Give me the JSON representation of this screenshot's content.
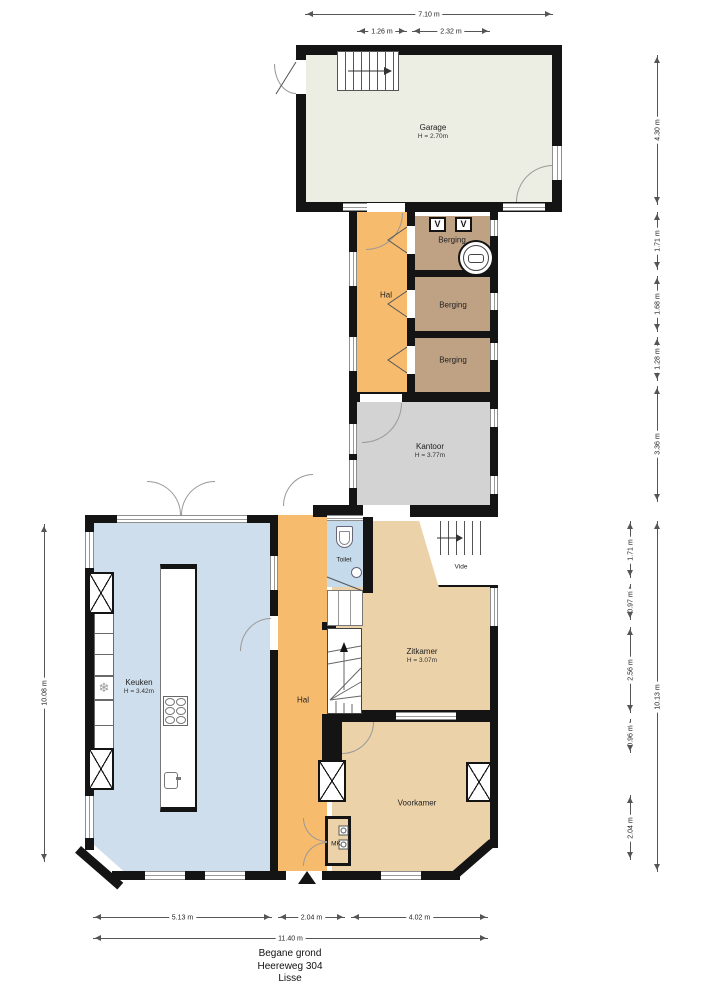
{
  "title": {
    "line1": "Begane grond",
    "line2": "Heereweg 304",
    "line3": "Lisse"
  },
  "rooms": {
    "garage": {
      "name": "Garage",
      "height": "H = 2.70m"
    },
    "hal_upper": {
      "name": "Hal"
    },
    "berging1": {
      "name": "Berging"
    },
    "berging2": {
      "name": "Berging"
    },
    "berging3": {
      "name": "Berging"
    },
    "kantoor": {
      "name": "Kantoor",
      "height": "H = 3.77m"
    },
    "keuken": {
      "name": "Keuken",
      "height": "H = 3.42m"
    },
    "hal_lower": {
      "name": "Hal"
    },
    "toilet": {
      "name": "Toilet"
    },
    "vide": {
      "name": "Vide"
    },
    "zitkamer": {
      "name": "Zitkamer",
      "height": "H = 3.07m"
    },
    "voorkamer": {
      "name": "Voorkamer"
    },
    "mk": {
      "name": "MK"
    }
  },
  "icons": {
    "snowflake": "❄",
    "vent_symbol": "V"
  },
  "colors": {
    "wall": "#141414",
    "garage_fill": "#ecede3",
    "hal_fill": "#f7bb6e",
    "berging_fill": "#bfa284",
    "kantoor_fill": "#d3d3d3",
    "keuken_fill": "#cfdeec",
    "toilet_fill": "#c5daeb",
    "living_fill": "#ecd2a9"
  },
  "dimensions": [
    {
      "label": "7.10 m",
      "dir": "h",
      "x": 305,
      "y": 14,
      "len": 248
    },
    {
      "label": "1.26 m",
      "dir": "h",
      "x": 357,
      "y": 31,
      "len": 50
    },
    {
      "label": "2.32 m",
      "dir": "h",
      "x": 412,
      "y": 31,
      "len": 78
    },
    {
      "label": "4.30 m",
      "dir": "v",
      "x": 657,
      "y": 55,
      "len": 150
    },
    {
      "label": "1.71 m",
      "dir": "v",
      "x": 657,
      "y": 212,
      "len": 58
    },
    {
      "label": "1.68 m",
      "dir": "v",
      "x": 657,
      "y": 276,
      "len": 56
    },
    {
      "label": "1.28 m",
      "dir": "v",
      "x": 657,
      "y": 337,
      "len": 44
    },
    {
      "label": "3.36 m",
      "dir": "v",
      "x": 657,
      "y": 386,
      "len": 116
    },
    {
      "label": "1.71 m",
      "dir": "v",
      "x": 630,
      "y": 521,
      "len": 57
    },
    {
      "label": "0.97 m",
      "dir": "v",
      "x": 630,
      "y": 584,
      "len": 36
    },
    {
      "label": "2.56 m",
      "dir": "v",
      "x": 630,
      "y": 627,
      "len": 86
    },
    {
      "label": "0.96 m",
      "dir": "v",
      "x": 630,
      "y": 719,
      "len": 34
    },
    {
      "label": "2.04 m",
      "dir": "v",
      "x": 630,
      "y": 795,
      "len": 65
    },
    {
      "label": "10.13 m",
      "dir": "v",
      "x": 657,
      "y": 521,
      "len": 351
    },
    {
      "label": "10.08 m",
      "dir": "v",
      "x": 44,
      "y": 524,
      "len": 338
    },
    {
      "label": "5.13 m",
      "dir": "h",
      "x": 93,
      "y": 917,
      "len": 179
    },
    {
      "label": "2.04 m",
      "dir": "h",
      "x": 278,
      "y": 917,
      "len": 67
    },
    {
      "label": "4.02 m",
      "dir": "h",
      "x": 351,
      "y": 917,
      "len": 137
    },
    {
      "label": "11.40 m",
      "dir": "h",
      "x": 93,
      "y": 938,
      "len": 395
    }
  ]
}
